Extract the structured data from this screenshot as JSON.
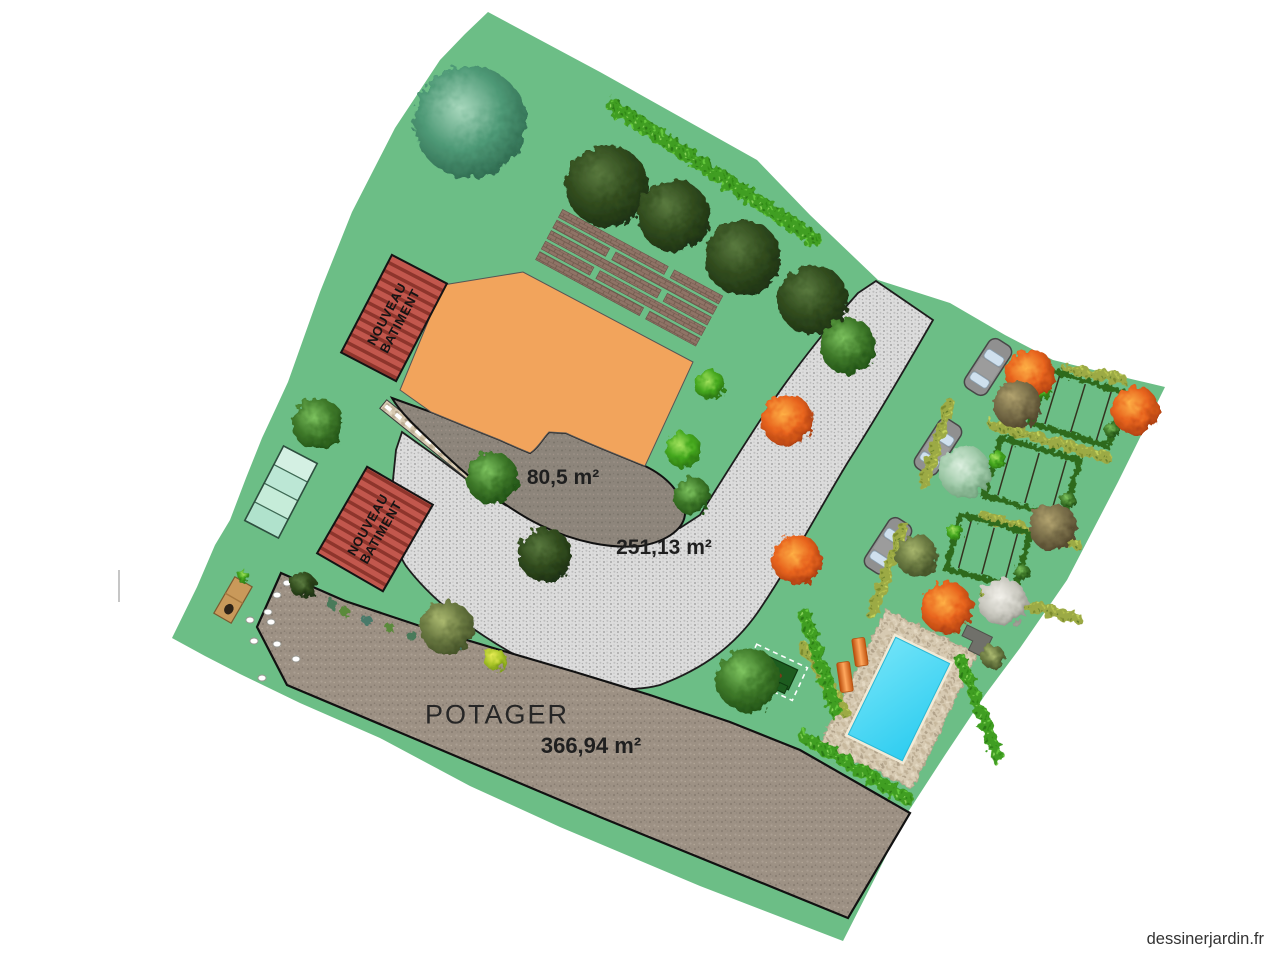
{
  "watermark": {
    "text": "dessinerjardin.fr"
  },
  "labels": {
    "terrace_area": "80,5 m²",
    "path_area": "251,13 m²",
    "potager_name": "POTAGER",
    "potager_area": "366,94 m²"
  },
  "new_building": {
    "line1": "NOUVEAU",
    "line2": "BATIMENT"
  },
  "palette": {
    "lawn_green": "#6CBE86",
    "building_orange": "#F2A45C",
    "new_building_red": "#C2574D",
    "roof_stripe_dark": "#8E352C",
    "path_gravel_gray": "#DCDCDC",
    "terrace_gray": "#8D857B",
    "potager_soil_brown": "#9D9184",
    "pool_water_cyan": "#3FD9F5",
    "pool_stone_beige": "#D7CAB2",
    "pergola_brown": "#8F7366",
    "greenhouse_mint": "#C8ECDC",
    "lounger_orange": "#E8741E",
    "car_gray": "#909090",
    "hedge_green": "#3F9E22",
    "label_text": "#1F1F1F"
  }
}
